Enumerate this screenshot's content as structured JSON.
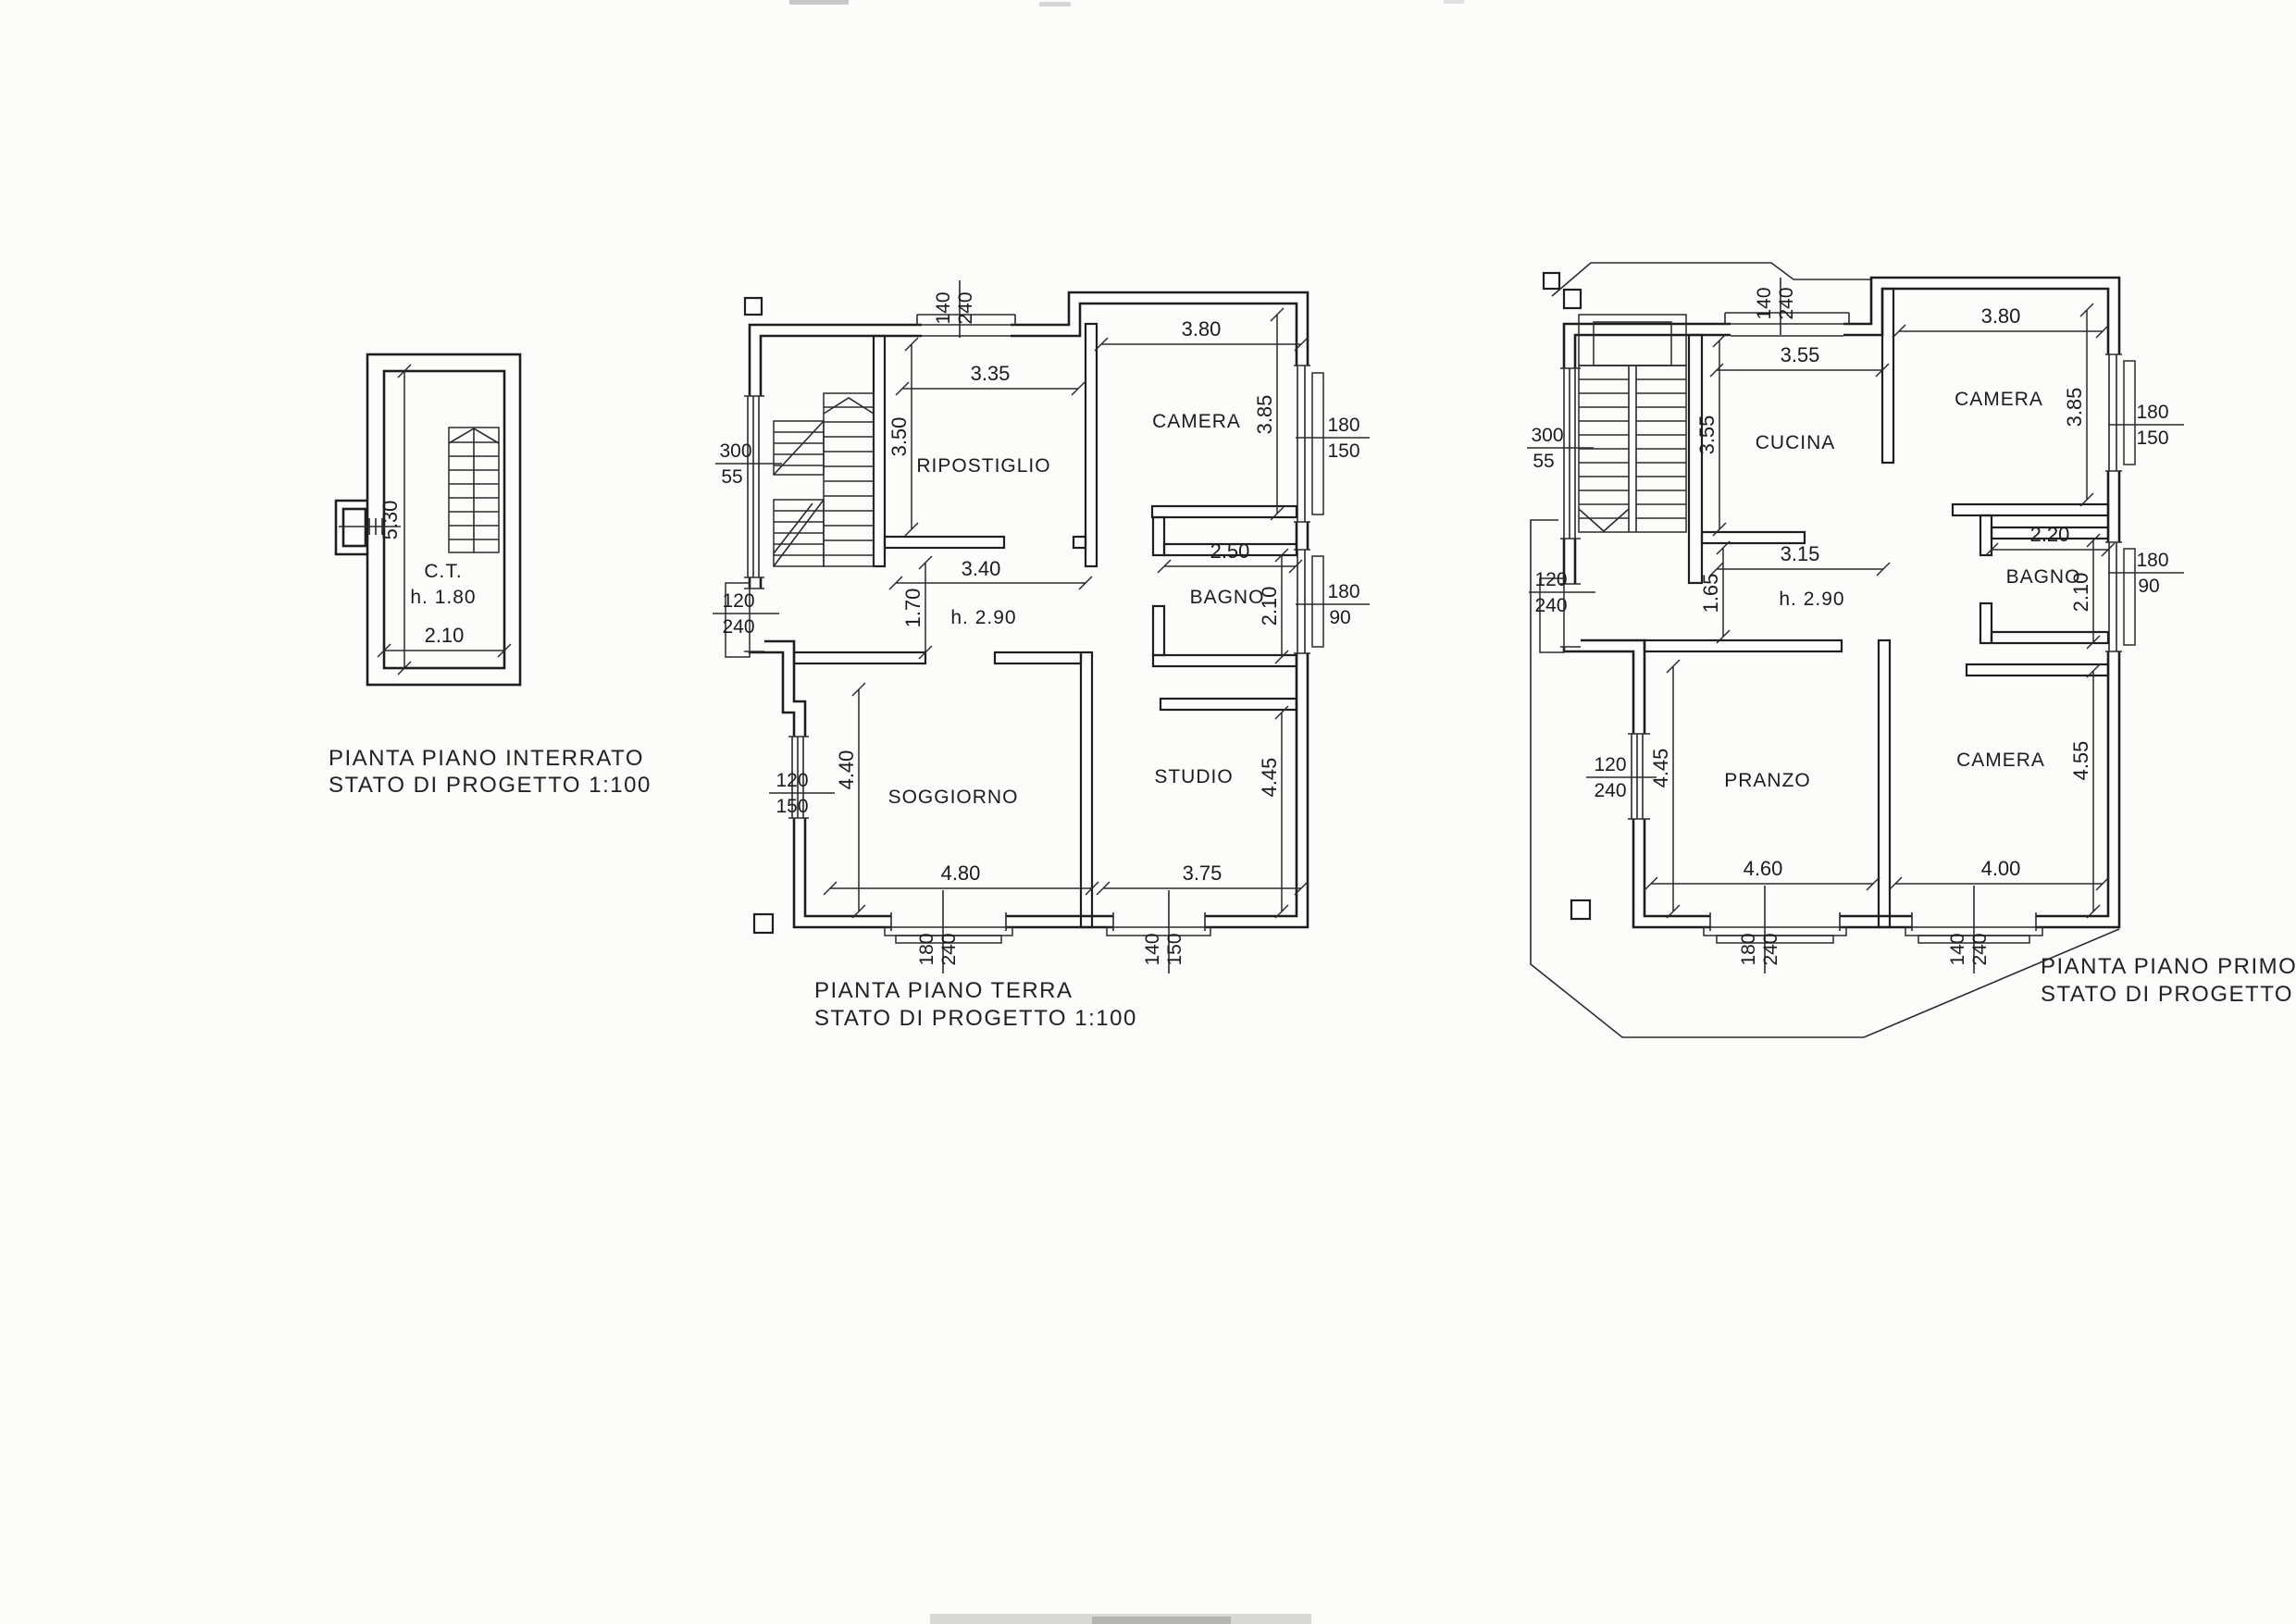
{
  "page": {
    "background": "#fcfcfa",
    "sheet_type": "scanned architectural drawing"
  },
  "plans": {
    "interrato": {
      "caption_line1": "PIANTA PIANO INTERRATO",
      "caption_line2": "STATO DI PROGETTO 1:100",
      "room": "C.T.",
      "room_height": "h.  1.80",
      "dim_depth": "5.30",
      "dim_width": "2.10"
    },
    "terra": {
      "caption_line1": "PIANTA PIANO TERRA",
      "caption_line2": "STATO DI PROGETTO 1:100",
      "height_label": "h.  2.90",
      "rooms": {
        "ripostiglio": "RIPOSTIGLIO",
        "camera": "CAMERA",
        "bagno": "BAGNO",
        "soggiorno": "SOGGIORNO",
        "studio": "STUDIO"
      },
      "dims": {
        "top_door_n": "140",
        "top_door_d": "240",
        "ripostiglio_w": "3.35",
        "ripostiglio_h": "3.50",
        "ripostiglio_bottom": "3.40",
        "camera_w": "3.80",
        "camera_h": "3.85",
        "camera_win_n": "180",
        "camera_win_d": "150",
        "bagno_w": "2.50",
        "bagno_h": "2.10",
        "bagno_win_n": "180",
        "bagno_win_d": "90",
        "stair_win_n": "300",
        "stair_win_d": "55",
        "entry_door_n": "120",
        "entry_door_d": "240",
        "corridor_h": "1.70",
        "sogg_win_n": "120",
        "sogg_win_d": "150",
        "sogg_h": "4.40",
        "sogg_w": "4.80",
        "sogg_door_n": "180",
        "sogg_door_d": "240",
        "studio_w": "3.75",
        "studio_h": "4.45",
        "studio_win_n": "140",
        "studio_win_d": "150"
      }
    },
    "primo": {
      "caption_line1": "PIANTA PIANO PRIMO",
      "caption_line2": "STATO DI PROGETTO",
      "height_label": "h.  2.90",
      "rooms": {
        "cucina": "CUCINA",
        "camera_top": "CAMERA",
        "bagno": "BAGNO",
        "pranzo": "PRANZO",
        "camera_bottom": "CAMERA"
      },
      "dims": {
        "top_door_n": "140",
        "top_door_d": "240",
        "cucina_w": "3.55",
        "cucina_h": "3.55",
        "cucina_bottom": "3.15",
        "camera_top_w": "3.80",
        "camera_top_h": "3.85",
        "camera_win_n": "180",
        "camera_win_d": "150",
        "bagno_w": "2.20",
        "bagno_h": "2.10",
        "bagno_win_n": "180",
        "bagno_win_d": "90",
        "stair_win_n": "300",
        "stair_win_d": "55",
        "entry_door_n": "120",
        "entry_door_d": "240",
        "corridor_h": "1.65",
        "pranzo_win_n": "120",
        "pranzo_win_d": "240",
        "pranzo_h": "4.45",
        "pranzo_w": "4.60",
        "pranzo_door_n": "180",
        "pranzo_door_d": "240",
        "camera_b_w": "4.00",
        "camera_b_h": "4.55",
        "camera_b_door_n": "140",
        "camera_b_door_d": "240"
      }
    }
  }
}
